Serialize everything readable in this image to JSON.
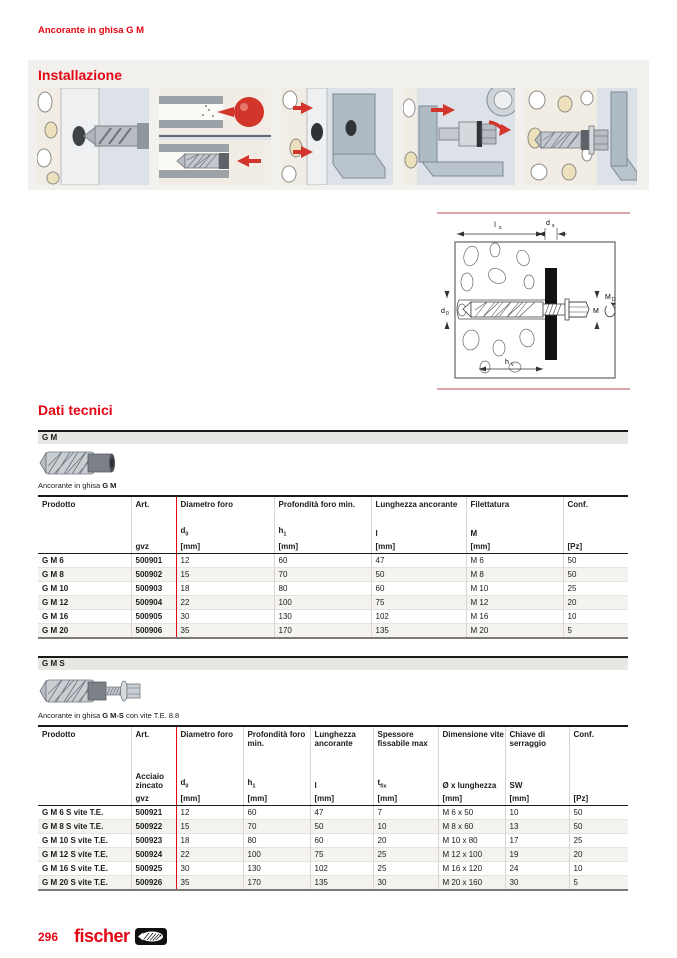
{
  "page": {
    "header": "Ancorante in ghisa G M",
    "page_number": "296",
    "brand": "fischer"
  },
  "installation": {
    "title": "Installazione",
    "steps": [
      "drill-hole",
      "clean-hole-insert-anchor",
      "position-fixture",
      "insert-bolt-torque",
      "anchor-installed"
    ]
  },
  "diagram": {
    "labels": {
      "length_main": "l",
      "length_sub": "s",
      "fixture_main": "d",
      "fixture_sub": "s",
      "hole_main": "d",
      "hole_sub": "0",
      "thread": "M",
      "torque_main": "M",
      "torque_sub": "D",
      "depth_main": "h",
      "depth_sub": "v"
    }
  },
  "dati": {
    "title": "Dati tecnici",
    "gm": {
      "band": "G M",
      "caption_prefix": "Ancorante in ghisa ",
      "caption_bold": "G M",
      "caption_suffix": "",
      "table": {
        "columns": [
          {
            "label": "Prodotto",
            "sym": "",
            "sub": "",
            "unit": ""
          },
          {
            "label": "Art.",
            "sym": "",
            "sub": "",
            "unit": "gvz"
          },
          {
            "label": "Diametro foro",
            "sym": "d",
            "sub": "0",
            "unit": "[mm]"
          },
          {
            "label": "Profondità foro min.",
            "sym": "h",
            "sub": "1",
            "unit": "[mm]"
          },
          {
            "label": "Lunghezza ancorante",
            "sym": "l",
            "sub": "",
            "unit": "[mm]"
          },
          {
            "label": "Filettatura",
            "sym": "M",
            "sub": "",
            "unit": "[mm]"
          },
          {
            "label": "Conf.",
            "sym": "",
            "sub": "",
            "unit": "[Pz]"
          }
        ],
        "rows": [
          [
            "G M 6",
            "500901",
            "12",
            "60",
            "47",
            "M 6",
            "50"
          ],
          [
            "G M 8",
            "500902",
            "15",
            "70",
            "50",
            "M 8",
            "50"
          ],
          [
            "G M 10",
            "500903",
            "18",
            "80",
            "60",
            "M 10",
            "25"
          ],
          [
            "G M 12",
            "500904",
            "22",
            "100",
            "75",
            "M 12",
            "20"
          ],
          [
            "G M 16",
            "500905",
            "30",
            "130",
            "102",
            "M 16",
            "10"
          ],
          [
            "G M 20",
            "500906",
            "35",
            "170",
            "135",
            "M 20",
            "5"
          ]
        ]
      }
    },
    "gms": {
      "band": "G M S",
      "caption_prefix": "Ancorante in ghisa ",
      "caption_bold": "G M-S",
      "caption_suffix": " con vite T.E. 8.8",
      "table": {
        "columns": [
          {
            "label": "Prodotto",
            "sym": "",
            "sub": "",
            "unit": ""
          },
          {
            "label": "Art.",
            "sym": "Acciaio zincato",
            "sub": "",
            "unit": "gvz"
          },
          {
            "label": "Diametro foro",
            "sym": "d",
            "sub": "0",
            "unit": "[mm]"
          },
          {
            "label": "Profondità foro min.",
            "sym": "h",
            "sub": "1",
            "unit": "[mm]"
          },
          {
            "label": "Lunghezza ancorante",
            "sym": "l",
            "sub": "",
            "unit": "[mm]"
          },
          {
            "label": "Spessore fissabile max",
            "sym": "t",
            "sub": "fix",
            "unit": "[mm]"
          },
          {
            "label": "Dimensione vite",
            "sym": "Ø x lunghezza",
            "sub": "",
            "unit": "[mm]"
          },
          {
            "label": "Chiave di serraggio",
            "sym": "SW",
            "sub": "",
            "unit": "[mm]"
          },
          {
            "label": "Conf.",
            "sym": "",
            "sub": "",
            "unit": "[Pz]"
          }
        ],
        "rows": [
          [
            "G M 6 S vite T.E.",
            "500921",
            "12",
            "60",
            "47",
            "7",
            "M 6 x 50",
            "10",
            "50"
          ],
          [
            "G M 8 S vite T.E.",
            "500922",
            "15",
            "70",
            "50",
            "10",
            "M 8 x 60",
            "13",
            "50"
          ],
          [
            "G M 10 S vite T.E.",
            "500923",
            "18",
            "80",
            "60",
            "20",
            "M 10 x 80",
            "17",
            "25"
          ],
          [
            "G M 12 S vite T.E.",
            "500924",
            "22",
            "100",
            "75",
            "25",
            "M 12 x 100",
            "19",
            "20"
          ],
          [
            "G M 16 S vite T.E.",
            "500925",
            "30",
            "130",
            "102",
            "25",
            "M 16 x 120",
            "24",
            "10"
          ],
          [
            "G M 20 S vite T.E.",
            "500926",
            "35",
            "170",
            "135",
            "30",
            "M 20 x 160",
            "30",
            "5"
          ]
        ]
      }
    }
  },
  "colors": {
    "accent": "#e30613",
    "band_gray": "#f2f1ee",
    "section_band": "#e9e7e3",
    "row_alt": "#f4f3f0"
  }
}
